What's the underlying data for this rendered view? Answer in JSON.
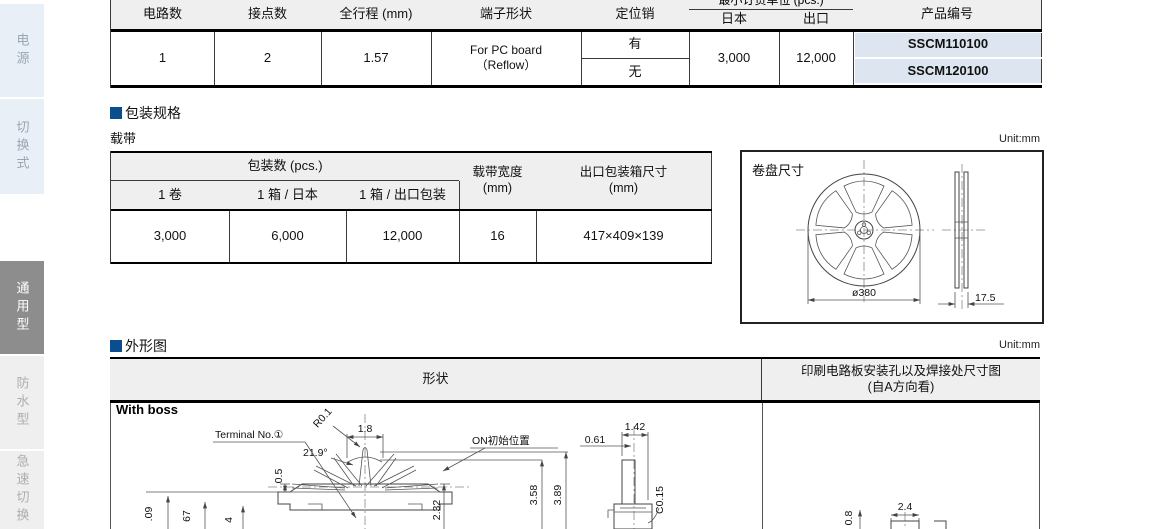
{
  "page": {
    "unit_label": "Unit:mm"
  },
  "sidebar": {
    "tabs": [
      {
        "label": "电源"
      },
      {
        "label": "切换式"
      },
      {
        "label": "通用型"
      },
      {
        "label": "防水型"
      },
      {
        "label": "急速切换"
      }
    ]
  },
  "spec_table": {
    "col_circuits": "电路数",
    "col_contacts": "接点数",
    "col_travel": "全行程 (mm)",
    "col_terminal": "端子形状",
    "col_pin": "定位销",
    "col_moq": "最小订货单位 (pcs.)",
    "col_japan": "日本",
    "col_export": "出口",
    "col_part": "产品编号",
    "circuits": "1",
    "contacts": "2",
    "travel": "1.57",
    "terminal_l1": "For PC board",
    "terminal_l2": "（Reflow）",
    "pin_yes": "有",
    "pin_no": "无",
    "moq_japan": "3,000",
    "moq_export": "12,000",
    "part_with_pin": "SSCM110100",
    "part_without_pin": "SSCM120100"
  },
  "packaging": {
    "section_title": "包装规格",
    "subtitle": "载带",
    "col_qty_group": "包装数 (pcs.)",
    "col_reel": "1 卷",
    "col_box_japan": "1 箱 / 日本",
    "col_box_export": "1 箱 / 出口包装",
    "col_tape_l1": "载带宽度",
    "col_tape_l2": "(mm)",
    "col_carton_l1": "出口包装箱尺寸",
    "col_carton_l2": "(mm)",
    "qty_reel": "3,000",
    "qty_box_japan": "6,000",
    "qty_box_export": "12,000",
    "tape_width": "16",
    "carton_size": "417×409×139",
    "reel_title": "卷盘尺寸",
    "reel_diameter": "ø380",
    "reel_width": "17.5"
  },
  "outline": {
    "section_title": "外形图",
    "col_shape": "形状",
    "col_pcb_l1": "印刷电路板安装孔以及焊接处尺寸图",
    "col_pcb_l2": "(自A方向看)",
    "variant": "With boss",
    "dims": {
      "radius": "R0.1",
      "top_width": "1.8",
      "angle": "21.9°",
      "terminal_label": "Terminal No.①",
      "on_position": "ON初始位置",
      "height_on": "3.58",
      "height_total": "3.89",
      "height_body": "2.32",
      "offset": "0.5",
      "left_frag1": ".09",
      "left_frag2": "67",
      "left_frag3": "4",
      "side_width": "1.42",
      "side_offset": "0.61",
      "chamfer": "C0.15",
      "pad_pitch": "2.4",
      "pad_height": "0.8"
    }
  }
}
